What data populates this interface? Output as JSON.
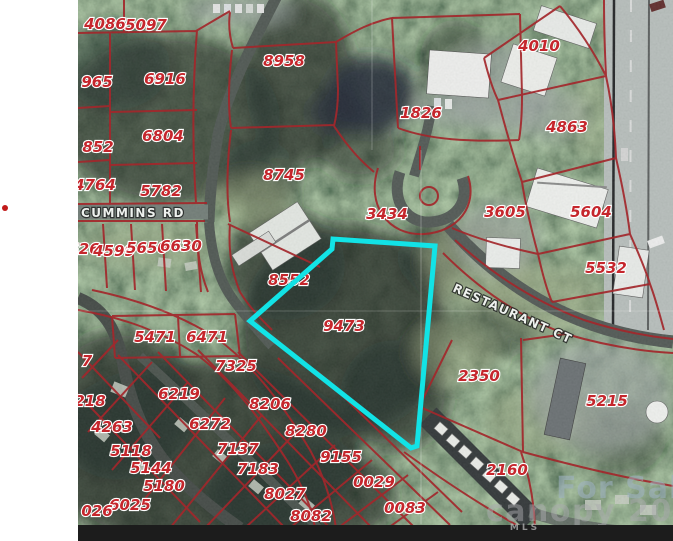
{
  "map": {
    "highlighted_parcel": "9473",
    "streets": {
      "cummins_rd": "CUMMINS RD",
      "restaurant_ct": "RESTAURANT CT"
    },
    "parcels": [
      "4086",
      "5097",
      "8958",
      "1826",
      "4010",
      "4863",
      "965",
      "6916",
      "852",
      "6804",
      "4764",
      "5782",
      "8745",
      "3434",
      "3605",
      "5604",
      "5532",
      "626",
      "4599",
      "5650",
      "6630",
      "8552",
      "9473",
      "2350",
      "5471",
      "6471",
      "7",
      "7325",
      "218",
      "6219",
      "8206",
      "6272",
      "4263",
      "8280",
      "7137",
      "9155",
      "5118",
      "5144",
      "7183",
      "0029",
      "5180",
      "8027",
      "6025",
      "026",
      "8082",
      "0083",
      "2160",
      "5215"
    ],
    "colors": {
      "parcel_line": "#a3272b",
      "parcel_label": "#c5262c",
      "highlight": "#12e3e6",
      "road": "#49514d",
      "bottom_bar": "#1c1c1c",
      "marker_dot": "#c11a1a"
    }
  },
  "watermark": {
    "for_sale": "For Sale",
    "brand": "canopy 202",
    "mls": "MLS"
  }
}
